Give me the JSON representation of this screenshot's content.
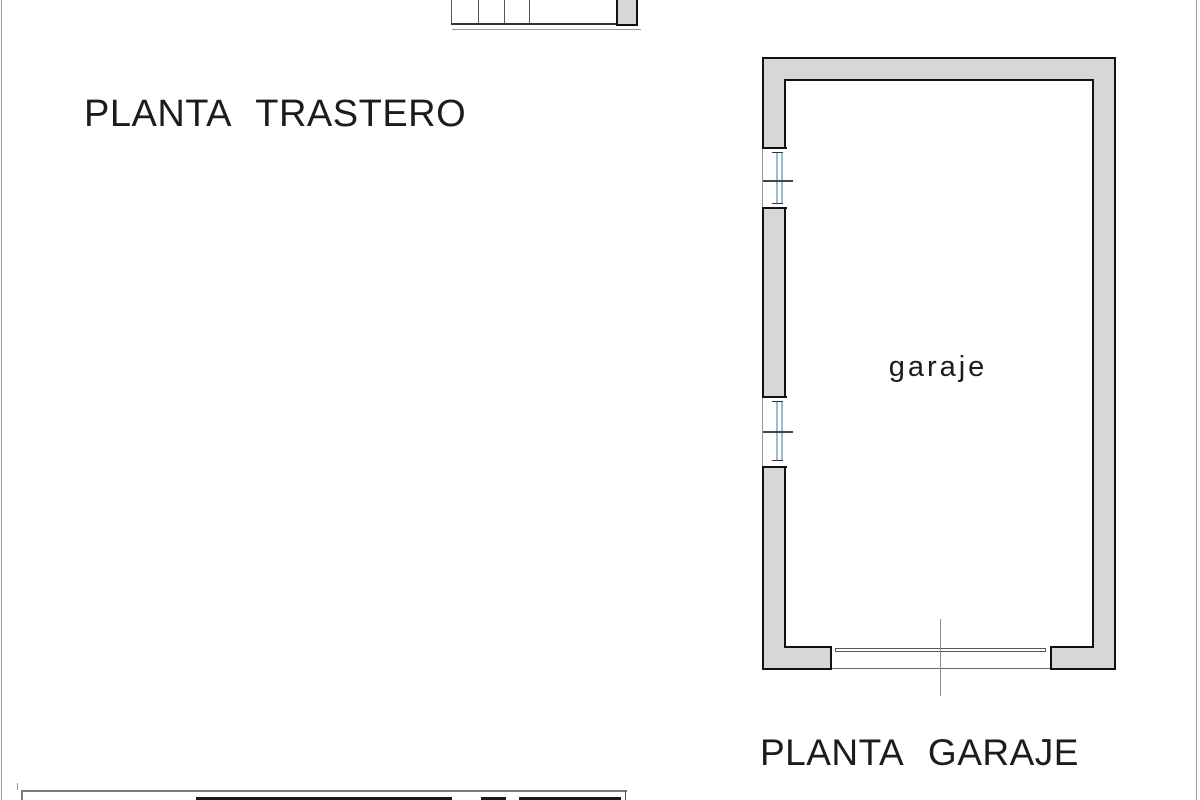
{
  "colors": {
    "background": "#ffffff",
    "page_border": "#9a9a9a",
    "wall_fill": "#d7d7d7",
    "wall_outline": "#111111",
    "thin_line": "#555555",
    "ground_line": "#999999",
    "window_glass": "#9bbdd4",
    "centerline": "#8c8c8c",
    "text": "#1c1c1c"
  },
  "labels": {
    "trastero_title": "PLANTA TRASTERO",
    "garaje_title": "PLANTA GARAJE",
    "garage_room": "garaje"
  }
}
